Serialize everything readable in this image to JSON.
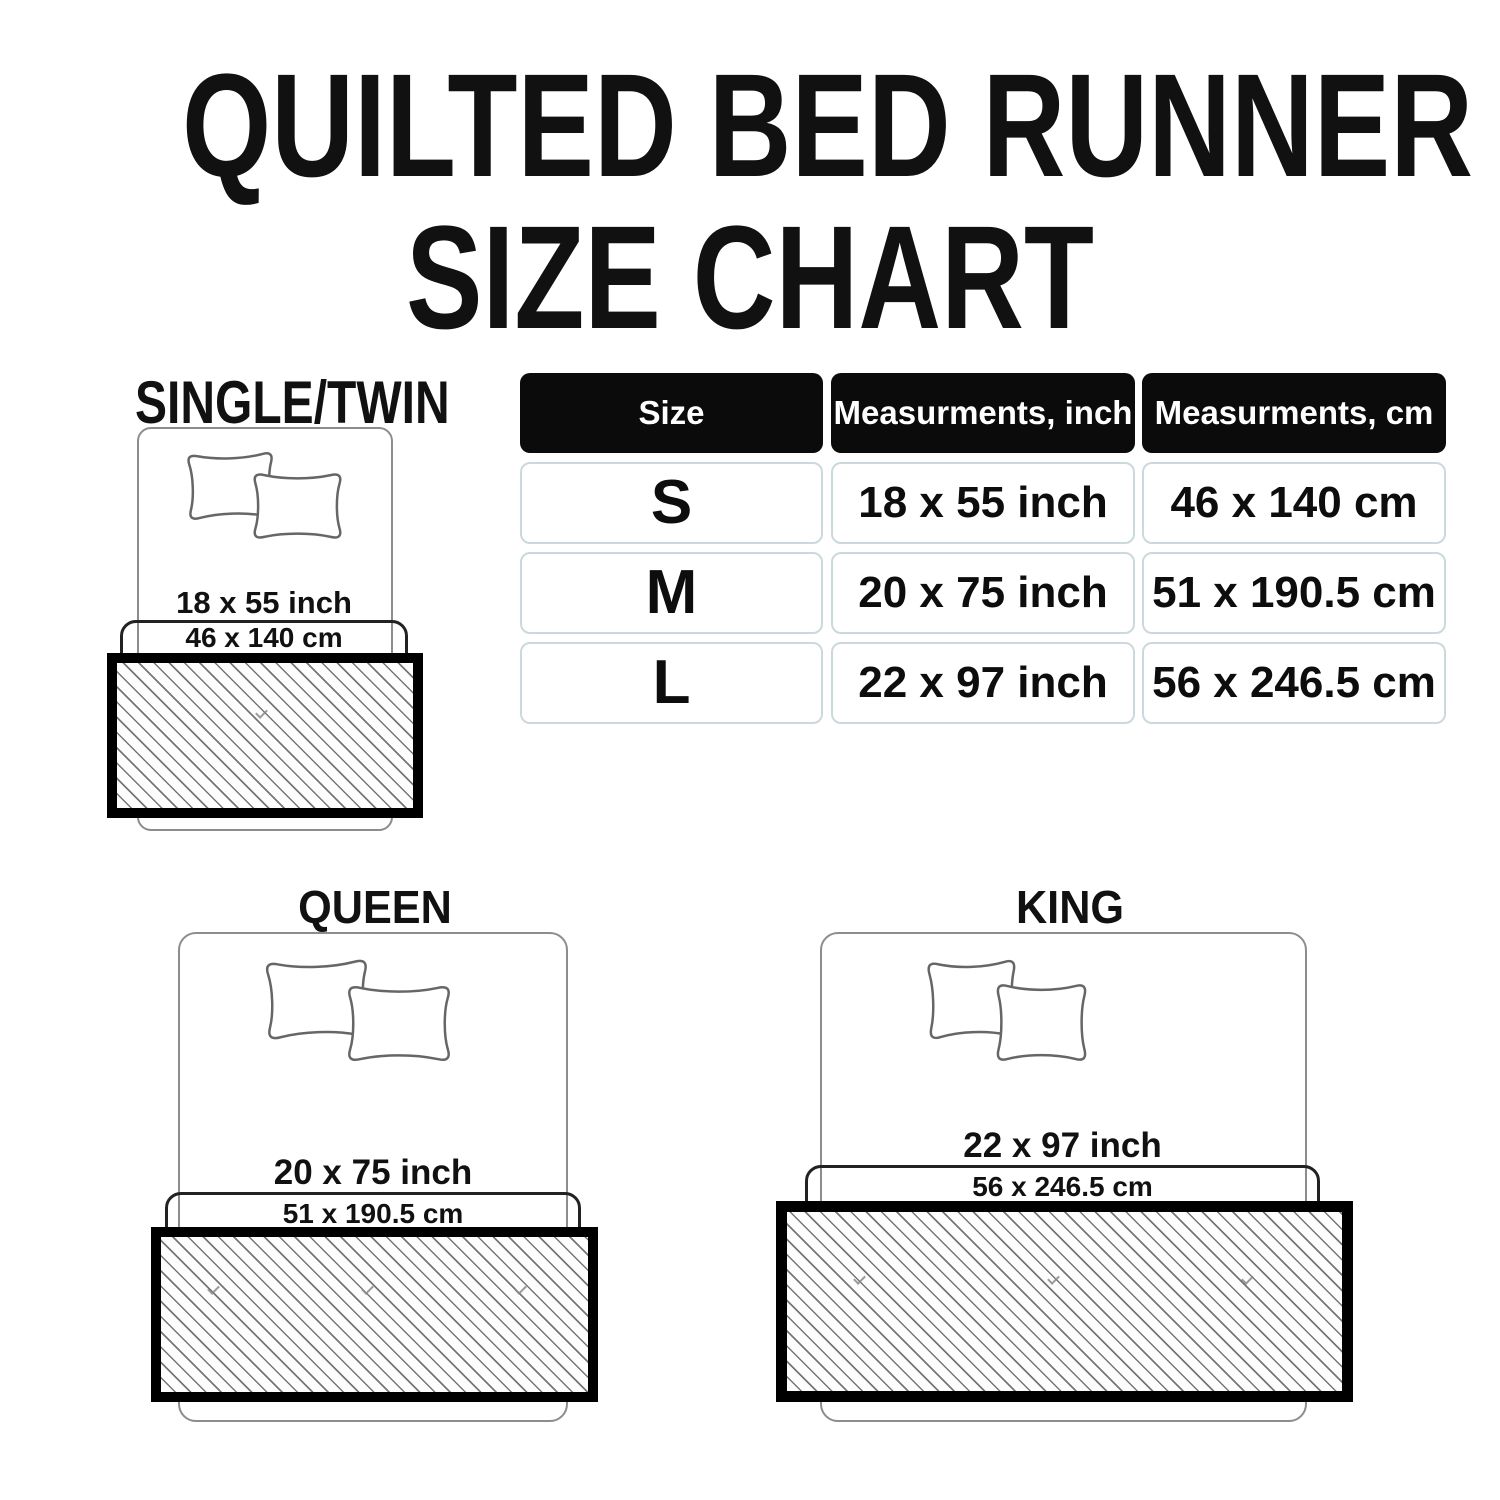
{
  "title": {
    "line1": "QUILTED BED RUNNER",
    "line2": "SIZE CHART"
  },
  "table": {
    "headers": [
      "Size",
      "Measurments, inch",
      "Measurments, cm"
    ],
    "rows": [
      {
        "size": "S",
        "inch": "18 x 55 inch",
        "cm": "46 x 140 cm"
      },
      {
        "size": "M",
        "inch": "20 x 75 inch",
        "cm": "51 x 190.5 cm"
      },
      {
        "size": "L",
        "inch": "22 x 97 inch",
        "cm": "56 x 246.5 cm"
      }
    ]
  },
  "diagrams": [
    {
      "label": "SINGLE/TWIN",
      "inch": "18 x 55 inch",
      "cm": "46 x 140 cm"
    },
    {
      "label": "QUEEN",
      "inch": "20 x 75 inch",
      "cm": "51 x 190.5 cm"
    },
    {
      "label": "KING",
      "inch": "22 x 97 inch",
      "cm": "56 x 246.5 cm"
    }
  ],
  "colors": {
    "text": "#111111",
    "table_header_bg": "#0b0b0b",
    "table_header_text": "#ffffff",
    "table_cell_border": "#ccd9dc",
    "bed_outline": "#8d8d8d",
    "sheet_outline": "#222222",
    "pillow_outline": "#666666",
    "runner_border": "#000000",
    "hatch_line": "#767676",
    "background": "#ffffff"
  }
}
